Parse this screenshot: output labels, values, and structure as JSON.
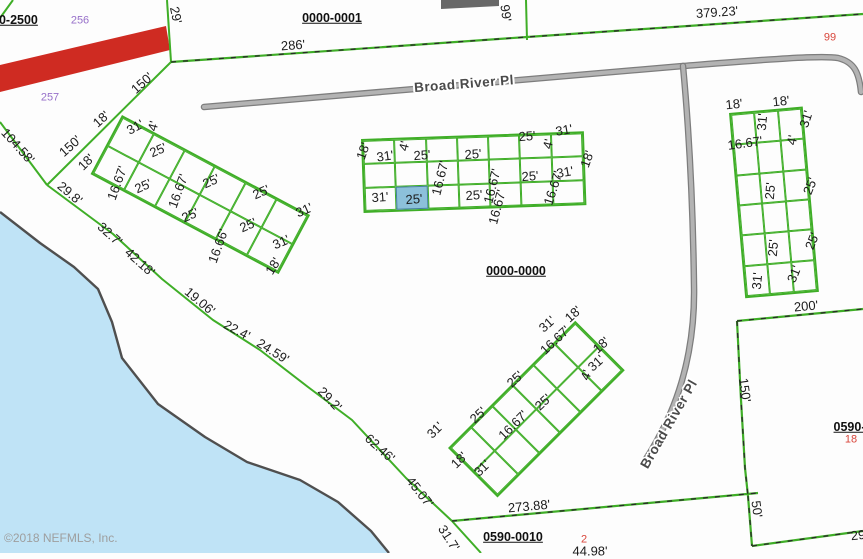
{
  "map": {
    "watermark": "©2018 NEFMLS, Inc.",
    "colors": {
      "parcel_line_green": "#3fae27",
      "water_fill": "#bfe3f6",
      "shoreline": "#4f4f4f",
      "road_gray": "#b3b3b3",
      "road_edge": "#7d7d7d",
      "highlight_lot_fill": "#8cc0da",
      "red_stripe": "#cf2b22",
      "purple_number": "#9770c9",
      "red_number": "#d9453a"
    },
    "road_labels": [
      {
        "text": "Broad River Pl",
        "x": 464,
        "y": 84,
        "r": -4.5
      },
      {
        "text": "Broad River Pl",
        "x": 669,
        "y": 424,
        "r": -60
      }
    ],
    "parcel_ids": [
      {
        "text": "0000-2500",
        "x": 8,
        "y": 20
      },
      {
        "text": "0000-0001",
        "x": 332,
        "y": 18
      },
      {
        "text": "0000-0000",
        "x": 516,
        "y": 271
      },
      {
        "text": "0590-0010",
        "x": 513,
        "y": 537
      },
      {
        "text": "0590-0",
        "x": 853,
        "y": 427
      }
    ],
    "lot_numbers": [
      {
        "text": "256",
        "x": 80,
        "y": 21,
        "color": "purple"
      },
      {
        "text": "257",
        "x": 50,
        "y": 98,
        "color": "purple"
      },
      {
        "text": "99",
        "x": 830,
        "y": 38,
        "color": "red"
      },
      {
        "text": "18",
        "x": 851,
        "y": 440,
        "color": "red"
      },
      {
        "text": "2",
        "x": 584,
        "y": 540,
        "color": "red"
      }
    ],
    "dim_labels": [
      {
        "x": 293,
        "y": 45,
        "r": -4,
        "t": "286'"
      },
      {
        "x": 717,
        "y": 12,
        "r": -4,
        "t": "379.23'"
      },
      {
        "x": 506,
        "y": 13,
        "r": 82,
        "t": "99'"
      },
      {
        "x": 176,
        "y": 15,
        "r": 78,
        "t": "29'"
      },
      {
        "x": 18,
        "y": 146,
        "r": 48,
        "t": "104.58'"
      },
      {
        "x": 142,
        "y": 83,
        "r": -42,
        "t": "150'"
      },
      {
        "x": 70,
        "y": 146,
        "r": -42,
        "t": "150'"
      },
      {
        "x": 86,
        "y": 162,
        "r": -45,
        "t": "18'"
      },
      {
        "x": 70,
        "y": 193,
        "r": 40,
        "t": "29.8'"
      },
      {
        "x": 110,
        "y": 234,
        "r": 42,
        "t": "32.7'"
      },
      {
        "x": 140,
        "y": 262,
        "r": 42,
        "t": "42.18'"
      },
      {
        "x": 200,
        "y": 301,
        "r": 40,
        "t": "19.06'"
      },
      {
        "x": 237,
        "y": 330,
        "r": 28,
        "t": "22.4'"
      },
      {
        "x": 273,
        "y": 351,
        "r": 32,
        "t": "24.59'"
      },
      {
        "x": 330,
        "y": 399,
        "r": 46,
        "t": "29.2'"
      },
      {
        "x": 380,
        "y": 448,
        "r": 42,
        "t": "62.46'"
      },
      {
        "x": 420,
        "y": 492,
        "r": 52,
        "t": "45.07'"
      },
      {
        "x": 449,
        "y": 538,
        "r": 57,
        "t": "31.7'"
      },
      {
        "x": 101,
        "y": 119,
        "r": -42,
        "t": "18'"
      },
      {
        "x": 135,
        "y": 127,
        "r": -28,
        "t": "31'"
      },
      {
        "x": 153,
        "y": 126,
        "r": -75,
        "t": "4'"
      },
      {
        "x": 117,
        "y": 183,
        "r": -70,
        "t": "16.67'"
      },
      {
        "x": 158,
        "y": 150,
        "r": -24,
        "t": "25'"
      },
      {
        "x": 143,
        "y": 186,
        "r": -24,
        "t": "25'"
      },
      {
        "x": 178,
        "y": 191,
        "r": -70,
        "t": "16.67'"
      },
      {
        "x": 211,
        "y": 181,
        "r": -24,
        "t": "25'"
      },
      {
        "x": 190,
        "y": 215,
        "r": -24,
        "t": "25'"
      },
      {
        "x": 218,
        "y": 246,
        "r": -70,
        "t": "16.66'"
      },
      {
        "x": 261,
        "y": 192,
        "r": -24,
        "t": "25'"
      },
      {
        "x": 248,
        "y": 225,
        "r": -24,
        "t": "25'"
      },
      {
        "x": 304,
        "y": 210,
        "r": -24,
        "t": "31'"
      },
      {
        "x": 281,
        "y": 242,
        "r": -24,
        "t": "31'"
      },
      {
        "x": 273,
        "y": 266,
        "r": -58,
        "t": "18'"
      },
      {
        "x": 363,
        "y": 151,
        "r": -70,
        "t": "18'"
      },
      {
        "x": 385,
        "y": 156,
        "r": -8,
        "t": "31'"
      },
      {
        "x": 404,
        "y": 146,
        "r": -76,
        "t": "4'"
      },
      {
        "x": 422,
        "y": 155,
        "r": -4,
        "t": "25'"
      },
      {
        "x": 440,
        "y": 178,
        "r": -76,
        "t": "16.67'"
      },
      {
        "x": 473,
        "y": 154,
        "r": -4,
        "t": "25'"
      },
      {
        "x": 527,
        "y": 136,
        "r": -4,
        "t": "25'"
      },
      {
        "x": 564,
        "y": 130,
        "r": -10,
        "t": "31'"
      },
      {
        "x": 548,
        "y": 144,
        "r": -76,
        "t": "4'"
      },
      {
        "x": 587,
        "y": 159,
        "r": -70,
        "t": "18'"
      },
      {
        "x": 492,
        "y": 186,
        "r": -76,
        "t": "16.67'"
      },
      {
        "x": 530,
        "y": 176,
        "r": -4,
        "t": "25'"
      },
      {
        "x": 565,
        "y": 172,
        "r": -10,
        "t": "31'"
      },
      {
        "x": 553,
        "y": 188,
        "r": -72,
        "t": "16.67'"
      },
      {
        "x": 380,
        "y": 197,
        "r": -4,
        "t": "31'"
      },
      {
        "x": 414,
        "y": 199,
        "r": -4,
        "t": "25'"
      },
      {
        "x": 474,
        "y": 195,
        "r": -4,
        "t": "25'"
      },
      {
        "x": 497,
        "y": 207,
        "r": -75,
        "t": "16.67'"
      },
      {
        "x": 734,
        "y": 104,
        "r": -6,
        "t": "18'"
      },
      {
        "x": 781,
        "y": 101,
        "r": -6,
        "t": "18'"
      },
      {
        "x": 762,
        "y": 122,
        "r": -85,
        "t": "31'"
      },
      {
        "x": 806,
        "y": 119,
        "r": -72,
        "t": "31'"
      },
      {
        "x": 745,
        "y": 143,
        "r": -8,
        "t": "16.67'"
      },
      {
        "x": 792,
        "y": 140,
        "r": -78,
        "t": "4'"
      },
      {
        "x": 770,
        "y": 191,
        "r": -85,
        "t": "25'"
      },
      {
        "x": 810,
        "y": 186,
        "r": -68,
        "t": "25'"
      },
      {
        "x": 773,
        "y": 248,
        "r": -85,
        "t": "25'"
      },
      {
        "x": 812,
        "y": 241,
        "r": -68,
        "t": "25'"
      },
      {
        "x": 757,
        "y": 281,
        "r": -85,
        "t": "31'"
      },
      {
        "x": 794,
        "y": 274,
        "r": -68,
        "t": "31'"
      },
      {
        "x": 806,
        "y": 306,
        "r": -5,
        "t": "200'"
      },
      {
        "x": 435,
        "y": 430,
        "r": -45,
        "t": "31'"
      },
      {
        "x": 459,
        "y": 460,
        "r": -45,
        "t": "18'"
      },
      {
        "x": 482,
        "y": 468,
        "r": -45,
        "t": "31'"
      },
      {
        "x": 478,
        "y": 415,
        "r": -43,
        "t": "25'"
      },
      {
        "x": 515,
        "y": 379,
        "r": -43,
        "t": "25'"
      },
      {
        "x": 513,
        "y": 425,
        "r": -45,
        "t": "16.67'"
      },
      {
        "x": 543,
        "y": 402,
        "r": -43,
        "t": "25'"
      },
      {
        "x": 555,
        "y": 340,
        "r": -43,
        "t": "16.67'"
      },
      {
        "x": 573,
        "y": 314,
        "r": -42,
        "t": "18'"
      },
      {
        "x": 547,
        "y": 324,
        "r": -42,
        "t": "31'"
      },
      {
        "x": 601,
        "y": 345,
        "r": -42,
        "t": "18'"
      },
      {
        "x": 596,
        "y": 363,
        "r": -42,
        "t": "31'"
      },
      {
        "x": 586,
        "y": 375,
        "r": -70,
        "t": "4'"
      },
      {
        "x": 745,
        "y": 390,
        "r": 82,
        "t": "150'"
      },
      {
        "x": 757,
        "y": 509,
        "r": 82,
        "t": "50'"
      },
      {
        "x": 529,
        "y": 506,
        "r": -5,
        "t": "273.88'"
      },
      {
        "x": 858,
        "y": 535,
        "r": -6,
        "t": "29"
      },
      {
        "x": 590,
        "y": 551,
        "r": 0,
        "t": "44.98'"
      }
    ],
    "clusters": [
      {
        "id": "cluster-left-lots",
        "x": 122,
        "y": 115,
        "w": 213,
        "h": 67,
        "rot": 28,
        "cols": 6,
        "rows": 2
      },
      {
        "id": "cluster-center-lots",
        "x": 361,
        "y": 139,
        "w": 223,
        "h": 74,
        "rot": -2,
        "cols": 7,
        "rows": 3,
        "highlight": {
          "row": 2,
          "col": 1
        }
      },
      {
        "id": "cluster-right-lots",
        "x": 729,
        "y": 113,
        "w": 74,
        "h": 186,
        "rot": -5,
        "cols": 3,
        "rows": 6
      },
      {
        "id": "cluster-bottom-lots",
        "x": 448,
        "y": 448,
        "w": 180,
        "h": 70,
        "rot": -45,
        "cols": 6,
        "rows": 2
      }
    ]
  }
}
